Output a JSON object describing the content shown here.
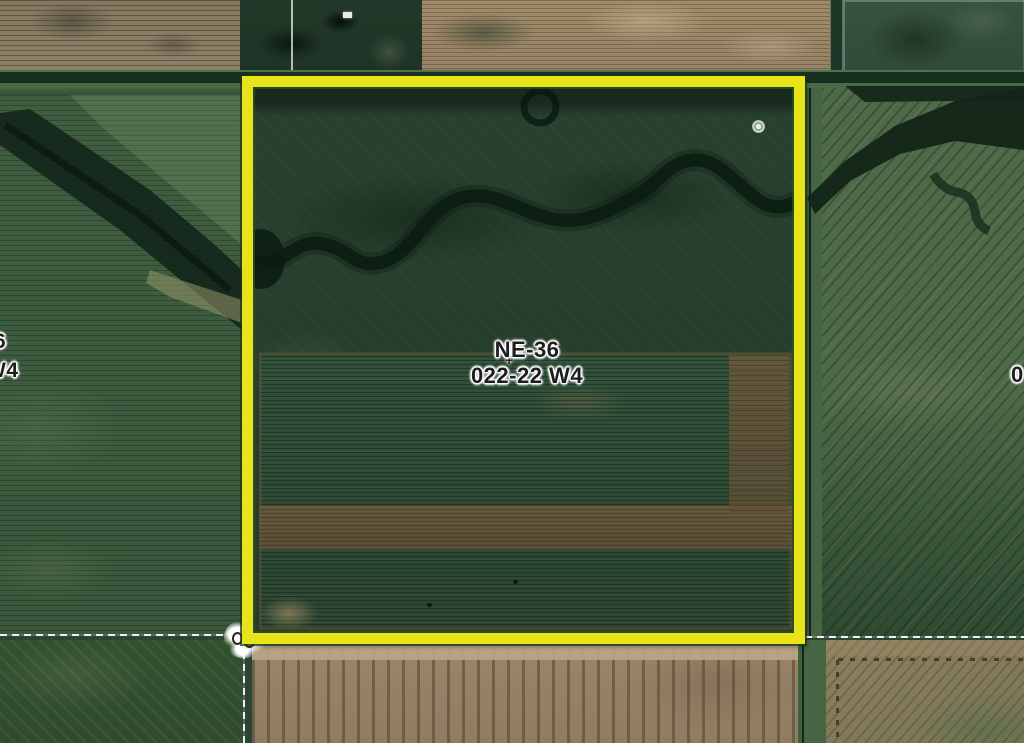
{
  "map": {
    "view": "aerial-imagery-with-cadastral-overlay",
    "parcel_label": {
      "line1": "NE-36",
      "line2": "022-22 W4"
    },
    "edge_label_west": {
      "line1": "6",
      "line2": "W4"
    },
    "edge_label_east": {
      "text": "0"
    },
    "center_cross_glyph": "+",
    "highlight": {
      "shape": "rectangle",
      "color": "#E9E31A",
      "meaning": "selected quarter-section parcel"
    },
    "survey_line_color": "#FFFFFF",
    "label_style": {
      "text_color": "#1E1E1E",
      "halo_color": "#FFFFFF"
    },
    "icons": {
      "section_corner_marker": "double-ring-survey-marker",
      "well_ring_marker": "small-circle-marker"
    }
  }
}
